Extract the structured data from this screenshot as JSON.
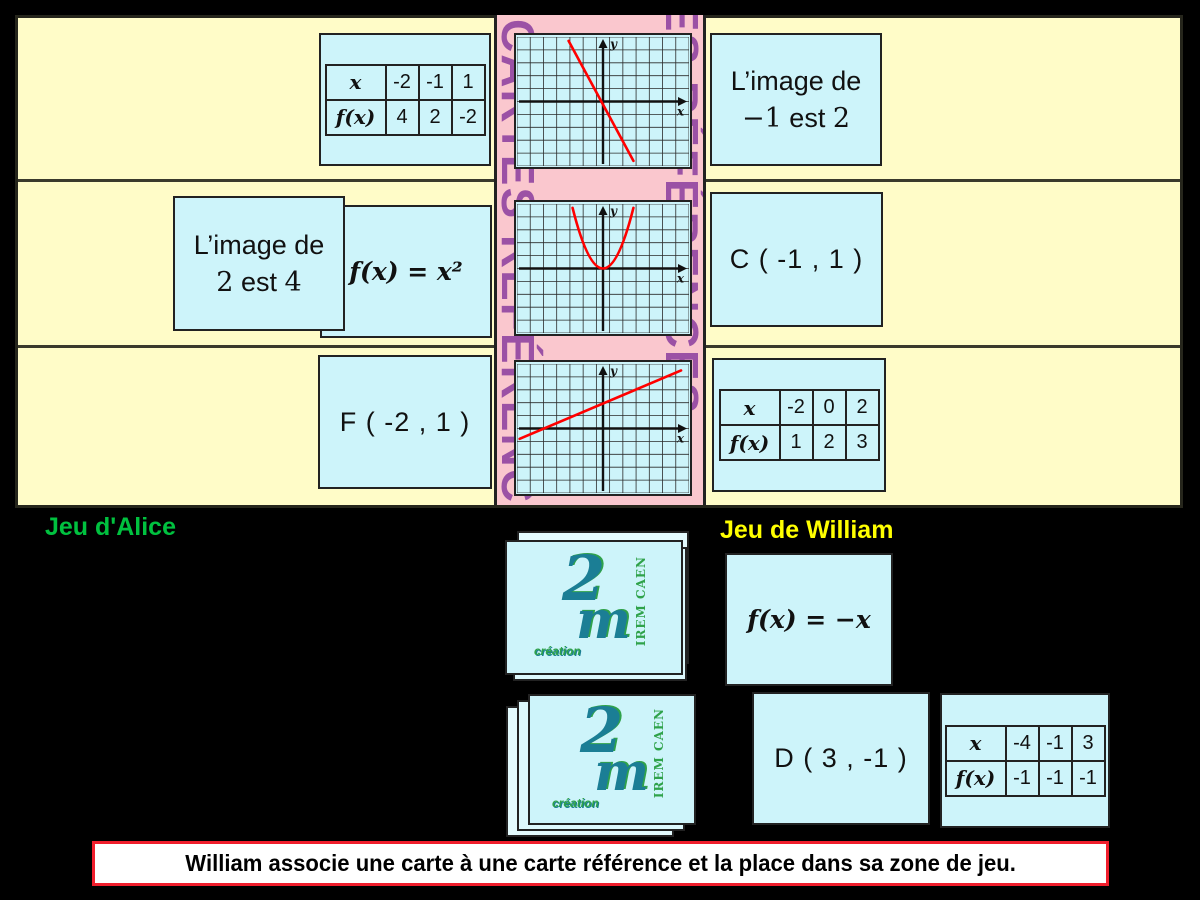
{
  "colors": {
    "board": "#FFFCC8",
    "reference_bg": "#FAC7CE",
    "card": "#CDF4FA",
    "accent_purple": "#9B51A5",
    "alice_green": "#00C13F",
    "william_yellow": "#FFFF00",
    "curve_red": "#FF0000",
    "message_border": "#F01E2C",
    "logo_teal": "#1B7E95",
    "logo_green": "#2FA24A"
  },
  "reference_column": {
    "vertical_left": "CARTES RÉFÉRENCES",
    "vertical_right": "CARTES RÉFÉRENCES"
  },
  "chart_data": [
    {
      "type": "line",
      "name": "decreasing-line-graph",
      "xlabel": "x",
      "ylabel": "y",
      "cols": 13,
      "rows": 10,
      "y_axis_col": 6.5,
      "x_axis_row": 5,
      "curve": {
        "kind": "line",
        "from": [
          -2.6,
          4.7
        ],
        "to": [
          2.3,
          -4.6
        ]
      },
      "comment": "red line through origin, slope -2"
    },
    {
      "type": "line",
      "name": "parabola-graph",
      "xlabel": "x",
      "ylabel": "y",
      "cols": 13,
      "rows": 10,
      "y_axis_col": 6.5,
      "x_axis_row": 5,
      "curve": {
        "kind": "parabola",
        "half_width": 2.3,
        "top": 4.7
      },
      "comment": "red parabola y = x², vertex at origin"
    },
    {
      "type": "line",
      "name": "increasing-line-graph",
      "xlabel": "x",
      "ylabel": "y",
      "cols": 13,
      "rows": 10,
      "y_axis_col": 6.5,
      "x_axis_row": 5,
      "curve": {
        "kind": "line",
        "from": [
          -6.3,
          -0.8
        ],
        "to": [
          5.9,
          4.5
        ]
      },
      "comment": "red line slope 1/2, y-intercept 2"
    }
  ],
  "tables": {
    "t1": {
      "col_label": "x",
      "row_label": "f(x)",
      "x_values": [
        "-2",
        "-1",
        "1"
      ],
      "fx_values": [
        "4",
        "2",
        "-2"
      ]
    },
    "t2": {
      "col_label": "x",
      "row_label": "f(x)",
      "x_values": [
        "-2",
        "0",
        "2"
      ],
      "fx_values": [
        "1",
        "2",
        "3"
      ]
    },
    "t3": {
      "col_label": "x",
      "row_label": "f(x)",
      "x_values": [
        "-4",
        "-1",
        "3"
      ],
      "fx_values": [
        "-1",
        "-1",
        "-1"
      ]
    }
  },
  "cards": {
    "image1": {
      "line1": "L’image de",
      "line2": [
        [
          "−1",
          true
        ],
        [
          " est ",
          false
        ],
        [
          "2",
          true
        ]
      ]
    },
    "image2": {
      "line1": "L’image de",
      "line2": [
        [
          "2",
          true
        ],
        [
          " est ",
          false
        ],
        [
          "4",
          true
        ]
      ]
    },
    "formula_square": "f(x) = x²",
    "formula_neg": "f(x) = −x",
    "point_c": "C ( -1 , 1 )",
    "point_f": "F ( -2 , 1 )",
    "point_d": "D ( 3 , -1 )"
  },
  "labels": {
    "alice": "Jeu d'Alice",
    "william": "Jeu de William"
  },
  "logo": {
    "numeral": "2",
    "letter": "m",
    "vertical": "IREM CAEN",
    "script": "création"
  },
  "message": "William associe une carte à une carte référence et la place dans sa zone de jeu."
}
